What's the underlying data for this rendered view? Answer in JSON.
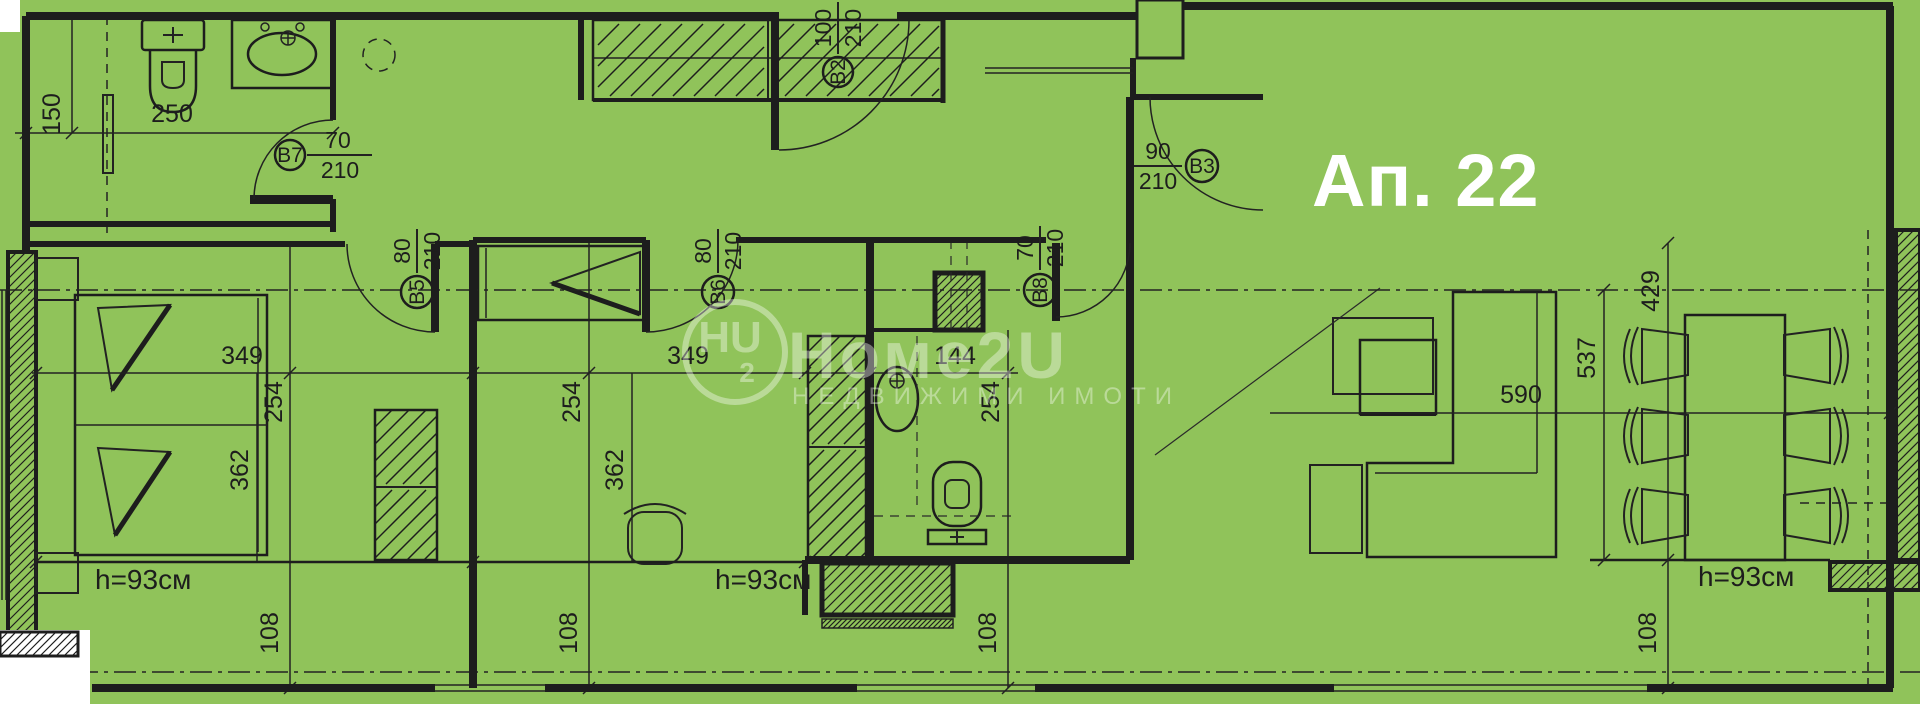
{
  "title": {
    "apartment_label": "Ап. 22"
  },
  "watermark": {
    "logo_main": "HU",
    "logo_sub": "2",
    "brand": "Номе2U",
    "tagline": "НЕДВИЖИМИ ИМОТИ"
  },
  "doors": {
    "B2": {
      "id": "B2",
      "width": "100",
      "height": "210"
    },
    "B3": {
      "id": "B3",
      "width": "90",
      "height": "210"
    },
    "B5": {
      "id": "B5",
      "width": "80",
      "height": "210"
    },
    "B6": {
      "id": "B6",
      "width": "80",
      "height": "210"
    },
    "B7": {
      "id": "B7",
      "width": "70",
      "height": "210"
    },
    "B8": {
      "id": "B8",
      "width": "70",
      "height": "210"
    }
  },
  "dims": {
    "bath1": {
      "w": "250",
      "h": "150"
    },
    "bed1": {
      "a": "349",
      "b": "254",
      "c": "362"
    },
    "bed2": {
      "a": "349",
      "b": "254",
      "c": "362"
    },
    "bath2": {
      "a": "144",
      "b": "254"
    },
    "living": {
      "a": "590"
    },
    "dining": {
      "a": "429",
      "b": "537"
    },
    "offsets": [
      "108",
      "108",
      "108",
      "108"
    ],
    "sills": [
      "h=93см",
      "h=93см",
      "h=93см"
    ]
  },
  "colors": {
    "background": "#90C35A",
    "line": "#1d1d1d",
    "title_text": "#ffffff"
  }
}
